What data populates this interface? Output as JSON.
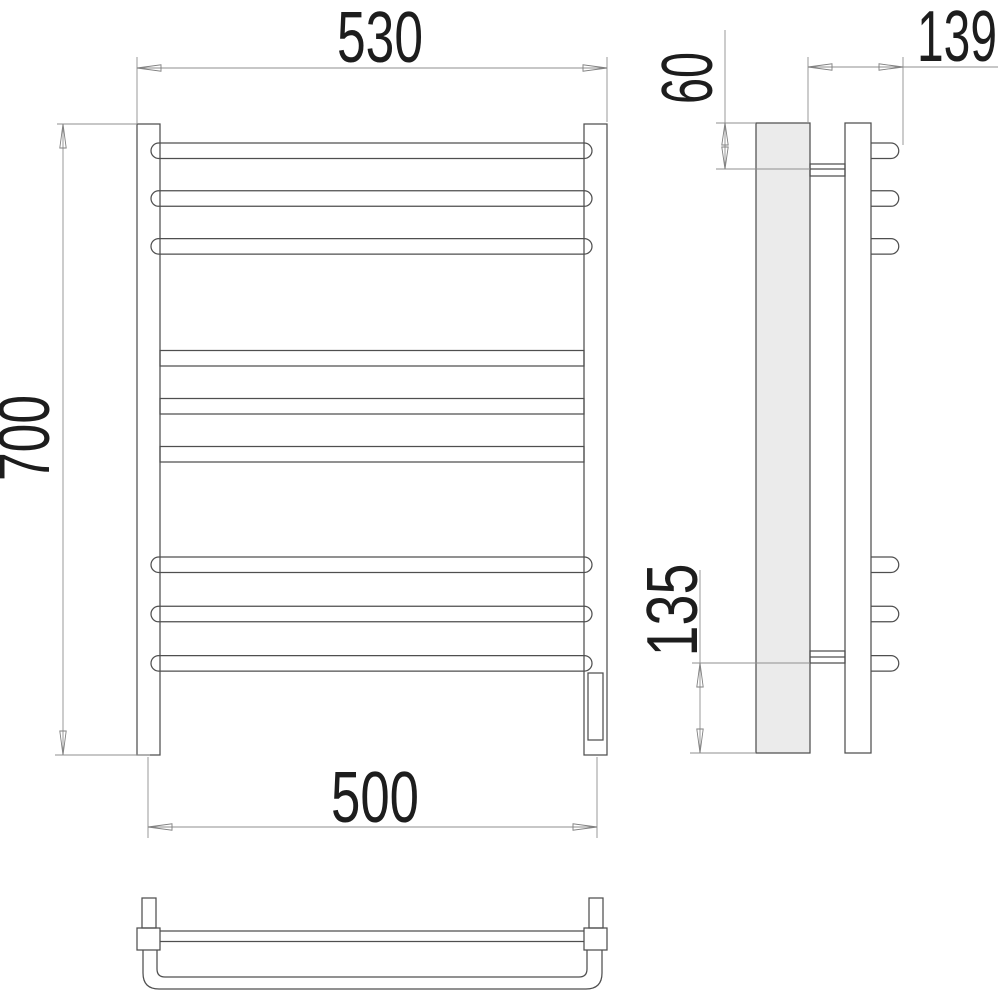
{
  "drawing": {
    "type": "technical-dimension-drawing",
    "subject": "ladder-style heated towel rail, front / side / bottom views",
    "dims": {
      "overall_width": "530",
      "overall_height": "700",
      "mounting_width": "500",
      "depth": "139",
      "top_bracket_offset": "60",
      "bottom_bracket_offset": "135"
    },
    "colors": {
      "background": "#ffffff",
      "object_line": "#4f4f4f",
      "dimension_line": "#8f8f8f",
      "text": "#1d1d1d",
      "shaded_profile_fill": "#ebebeb"
    }
  }
}
